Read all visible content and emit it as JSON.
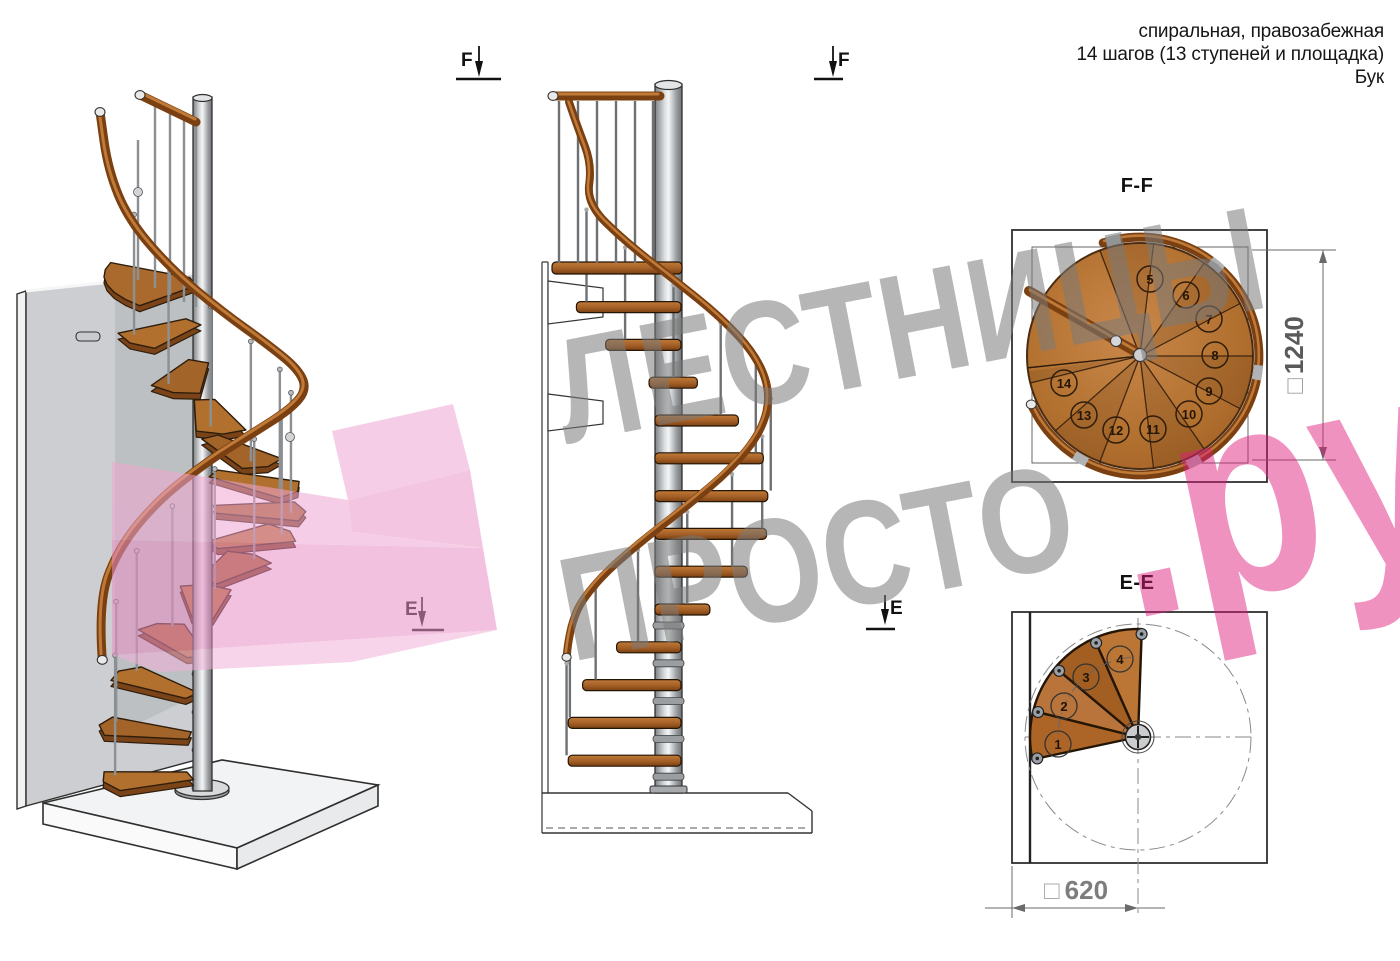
{
  "header": {
    "line1": "спиральная, правозабежная",
    "line2": "14 шагов (13 ступеней и площадка)",
    "line3": "Бук"
  },
  "markers": {
    "f": "F",
    "e": "E"
  },
  "plan_ff": {
    "title": "F-F",
    "dim_square": "□",
    "dimension": "1240",
    "steps": [
      "5",
      "6",
      "7",
      "8",
      "9",
      "10",
      "11",
      "12",
      "13",
      "14"
    ]
  },
  "plan_ee": {
    "title": "E-E",
    "dim_square": "□",
    "dimension": "620",
    "steps": [
      "1",
      "2",
      "3",
      "4"
    ]
  },
  "watermark": {
    "line1": "ЛЕСТНИЦЫ",
    "line2": "ПРОСТО",
    "suffix": ".ру"
  },
  "colors": {
    "wood": "#b2702f",
    "wood_dark": "#7b4012",
    "steel": "#c6c9cc",
    "pink": "#e01e7d",
    "watermark_gray": "#7d7d7d"
  }
}
